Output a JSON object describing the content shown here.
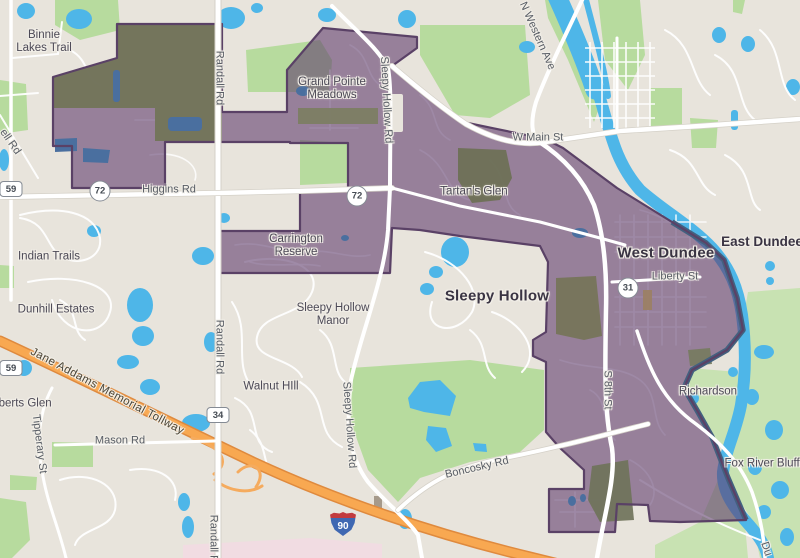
{
  "map": {
    "colors": {
      "land": "#e8e4dc",
      "park_green": "#b7db9e",
      "floodplain_green": "#c8e2b2",
      "water_blue": "#4eb6e8",
      "water_in_region": "#4a6f9f",
      "region_fill_overlay": "rgba(97,61,110,0.60)",
      "region_result_mauve": "#97809a",
      "region_stroke": "#5a4166",
      "river_boundary_stroke": "#43607f",
      "woods_in_region_olive": "#72755a",
      "tollway_orange": "#f8a851",
      "tollway_casing": "#df8a3e",
      "road_white": "#ffffff",
      "pink_zone": "#f1dce2"
    },
    "place_labels": [
      {
        "id": "binnie-lakes-trail",
        "text": "Binnie\nLakes Trail",
        "x": 44,
        "y": 42,
        "cls": "place",
        "rot": 0
      },
      {
        "id": "grand-pointe-meadows",
        "text": "Grand Pointe\nMeadows",
        "x": 332,
        "y": 89,
        "cls": "place",
        "rot": 0
      },
      {
        "id": "tartans-glen",
        "text": "Tartan's Glen",
        "x": 474,
        "y": 192,
        "cls": "place",
        "rot": 0
      },
      {
        "id": "carrington-reserve",
        "text": "Carrington\nReserve",
        "x": 296,
        "y": 246,
        "cls": "place",
        "rot": 0
      },
      {
        "id": "indian-trails",
        "text": "Indian Trails",
        "x": 49,
        "y": 257,
        "cls": "place",
        "rot": 0
      },
      {
        "id": "dunhill-estates",
        "text": "Dunhill Estates",
        "x": 56,
        "y": 310,
        "cls": "place",
        "rot": 0
      },
      {
        "id": "sleepy-hollow-manor",
        "text": "Sleepy Hollow\nManor",
        "x": 333,
        "y": 315,
        "cls": "place",
        "rot": 0
      },
      {
        "id": "walnut-hill",
        "text": "Walnut HIll",
        "x": 271,
        "y": 387,
        "cls": "place",
        "rot": 0
      },
      {
        "id": "alberts-glen",
        "text": "Alberts Glen",
        "x": 20,
        "y": 404,
        "cls": "place",
        "rot": 0
      },
      {
        "id": "richardson",
        "text": "Richardson",
        "x": 708,
        "y": 392,
        "cls": "place",
        "rot": 0
      },
      {
        "id": "fox-river-bluffs",
        "text": "Fox River Bluffs",
        "x": 765,
        "y": 464,
        "cls": "place",
        "rot": 0
      },
      {
        "id": "west-dundee",
        "text": "West Dundee",
        "x": 666,
        "y": 253,
        "cls": "city",
        "rot": 0
      },
      {
        "id": "sleepy-hollow",
        "text": "Sleepy Hollow",
        "x": 497,
        "y": 296,
        "cls": "city",
        "rot": 0
      },
      {
        "id": "east-dundee",
        "text": "East Dundee",
        "x": 762,
        "y": 242,
        "cls": "town",
        "rot": 0
      }
    ],
    "road_labels": [
      {
        "id": "higgins-rd",
        "text": "Higgins Rd",
        "x": 169,
        "y": 190,
        "cls": "road",
        "rot": 0
      },
      {
        "id": "w-main-st",
        "text": "W Main St",
        "x": 538,
        "y": 138,
        "cls": "road",
        "rot": 0
      },
      {
        "id": "liberty-st",
        "text": "Liberty St",
        "x": 675,
        "y": 277,
        "cls": "road",
        "rot": 0
      },
      {
        "id": "boncosky-rd",
        "text": "Boncosky Rd",
        "x": 477,
        "y": 468,
        "cls": "road",
        "rot": -13
      },
      {
        "id": "mason-rd",
        "text": "Mason Rd",
        "x": 120,
        "y": 441,
        "cls": "road",
        "rot": 0
      },
      {
        "id": "randall-rd-north",
        "text": "Randall Rd",
        "x": 219,
        "y": 78,
        "cls": "road",
        "rot": 90
      },
      {
        "id": "randall-rd-mid",
        "text": "Randall Rd",
        "x": 219,
        "y": 347,
        "cls": "road",
        "rot": 90
      },
      {
        "id": "randall-rd-south",
        "text": "Randall Rd",
        "x": 213,
        "y": 542,
        "cls": "road",
        "rot": 90
      },
      {
        "id": "sleepy-hollow-rd-north",
        "text": "Sleepy Hollow Rd",
        "x": 386,
        "y": 100,
        "cls": "road",
        "rot": 87
      },
      {
        "id": "sleepy-hollow-rd-south",
        "text": "Sleepy Hollow Rd",
        "x": 349,
        "y": 425,
        "cls": "road",
        "rot": 86
      },
      {
        "id": "n-western-ave",
        "text": "N Western Ave",
        "x": 537,
        "y": 36,
        "cls": "road",
        "rot": 66
      },
      {
        "id": "s-8th-st",
        "text": "S 8th St",
        "x": 607,
        "y": 390,
        "cls": "road",
        "rot": 90
      },
      {
        "id": "tipperary-st",
        "text": "Tipperary St",
        "x": 39,
        "y": 444,
        "cls": "road",
        "rot": 83
      },
      {
        "id": "jane-addams-memorial-tollway",
        "text": "Jane Addams Memorial Tollway",
        "x": 107,
        "y": 392,
        "cls": "toll",
        "rot": 28
      },
      {
        "id": "ell-rd",
        "text": "ell Rd",
        "x": 10,
        "y": 142,
        "cls": "road",
        "rot": 55
      },
      {
        "id": "du-road",
        "text": "Du",
        "x": 766,
        "y": 549,
        "cls": "road",
        "rot": 72
      }
    ],
    "shields": [
      {
        "id": "il-59-north",
        "type": "square",
        "text": "59",
        "x": 11,
        "y": 189
      },
      {
        "id": "il-59-south",
        "type": "square",
        "text": "59",
        "x": 11,
        "y": 368
      },
      {
        "id": "il-72-west",
        "type": "circle",
        "text": "72",
        "x": 100,
        "y": 191
      },
      {
        "id": "il-72-east",
        "type": "circle",
        "text": "72",
        "x": 357,
        "y": 196
      },
      {
        "id": "il-31",
        "type": "circle",
        "text": "31",
        "x": 628,
        "y": 288
      },
      {
        "id": "route-34",
        "type": "square",
        "text": "34",
        "x": 218,
        "y": 415
      },
      {
        "id": "i-90",
        "type": "interstate",
        "text": "90",
        "x": 343,
        "y": 524
      }
    ]
  }
}
